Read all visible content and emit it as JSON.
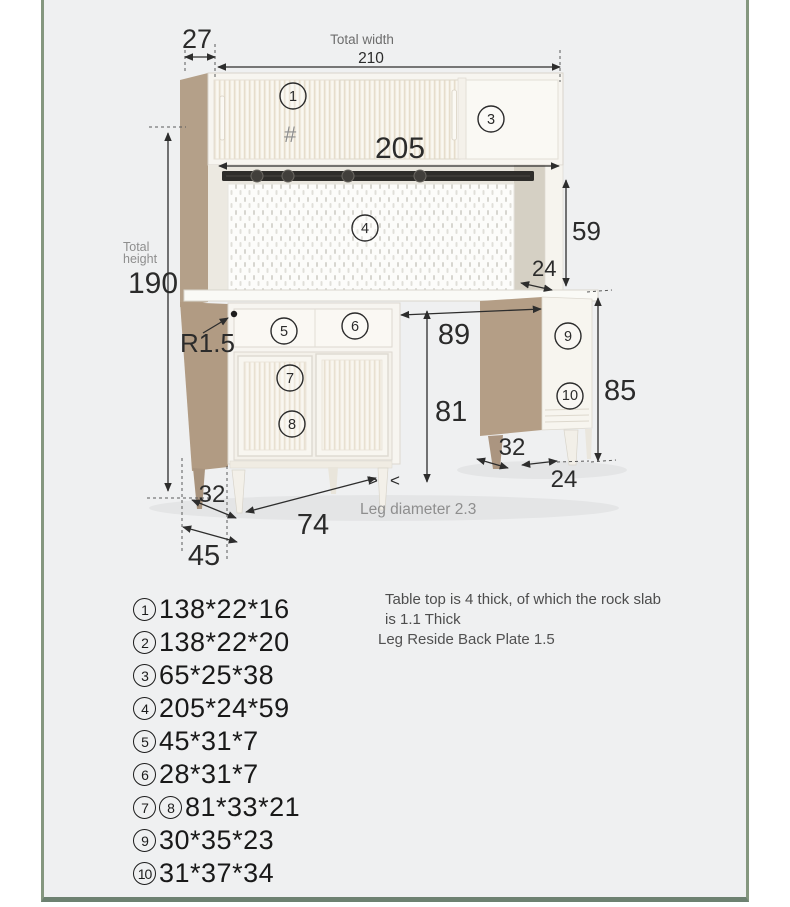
{
  "colors": {
    "panel_bg": "#eff0f1",
    "frame_border": "#85977f",
    "wood_tan": "#b29c85",
    "cabinet_white": "#f7f5f0",
    "rail_dark": "#2e2d2a",
    "dim_ink": "#2d2d2d"
  },
  "dims": {
    "top_offset": "27",
    "total_width_label": "Total width",
    "total_width": "210",
    "hutch_inner_width": "205",
    "pegboard_height": "59",
    "shelf_depth": "24",
    "total_height_label_1": "Total",
    "total_height_label_2": "height",
    "total_height": "190",
    "corner_radius": "R1.5",
    "knee_space_width": "89",
    "desk_height": "81",
    "pedestal_height": "85",
    "sideboard_leg_height": "32",
    "sideboard_leg_span": "74",
    "sideboard_depth": "45",
    "leg_diameter_note": "Leg diameter 2.3",
    "leg_pointer_left": ">",
    "leg_pointer_right": "<",
    "pedestal_leg_height": "32",
    "pedestal_depth": "24",
    "glass_hash": "#"
  },
  "callouts": {
    "c1": "1",
    "c3": "3",
    "c4": "4",
    "c5": "5",
    "c6": "6",
    "c7": "7",
    "c8": "8",
    "c9": "9",
    "c10": "10"
  },
  "specs": {
    "items": [
      {
        "marker": "1",
        "dims": "138*22*16"
      },
      {
        "marker": "2",
        "dims": "138*22*20"
      },
      {
        "marker": "3",
        "dims": "65*25*38"
      },
      {
        "marker": "4",
        "dims": "205*24*59"
      },
      {
        "marker": "5",
        "dims": "45*31*7"
      },
      {
        "marker": "6",
        "dims": "28*31*7"
      },
      {
        "marker": "7",
        "marker2": "8",
        "dims": "81*33*21"
      },
      {
        "marker": "9",
        "dims": "30*35*23"
      },
      {
        "marker": "10",
        "dims": "31*37*34"
      }
    ],
    "note1": "Table top is 4 thick, of which the rock slab is 1.1 Thick",
    "note2": "Leg Reside Back Plate 1.5"
  }
}
